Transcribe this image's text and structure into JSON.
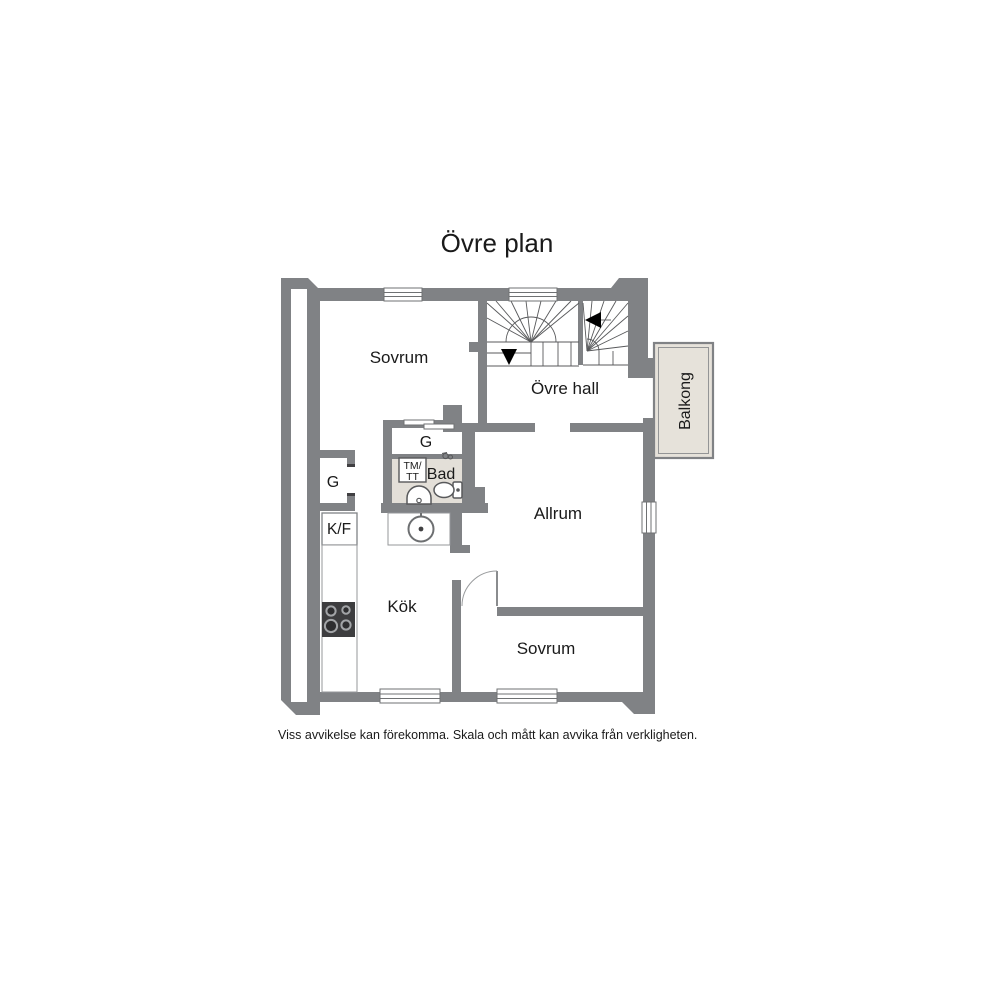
{
  "title": "Övre plan",
  "disclaimer": "Viss avvikelse kan förekomma. Skala och mått kan avvika från verkligheten.",
  "rooms": {
    "bedroom_top": "Sovrum",
    "upper_hall": "Övre hall",
    "living_room": "Allrum",
    "kitchen": "Kök",
    "bedroom_bottom": "Sovrum",
    "balcony": "Balkong"
  },
  "fixtures": {
    "wardrobe_left": "G",
    "wardrobe_center": "G",
    "fridge_freezer": "K/F",
    "bathroom": "Bad",
    "washer_line1": "TM/",
    "washer_line2": "TT"
  },
  "icons": {
    "stairs_down_arrow": "triangle-down",
    "stairs_direction_arrow": "triangle-left",
    "toilet": "toilet-top-view",
    "sink": "half-round-basin",
    "stove": "four-burner-hob",
    "round_table": "circle-with-dot"
  },
  "colors": {
    "wall": "#808285",
    "bath_floor": "#e3dfd8",
    "balcony_floor": "#e6e2da",
    "stove": "#3d3d3f",
    "text": "#1a1a1a"
  }
}
